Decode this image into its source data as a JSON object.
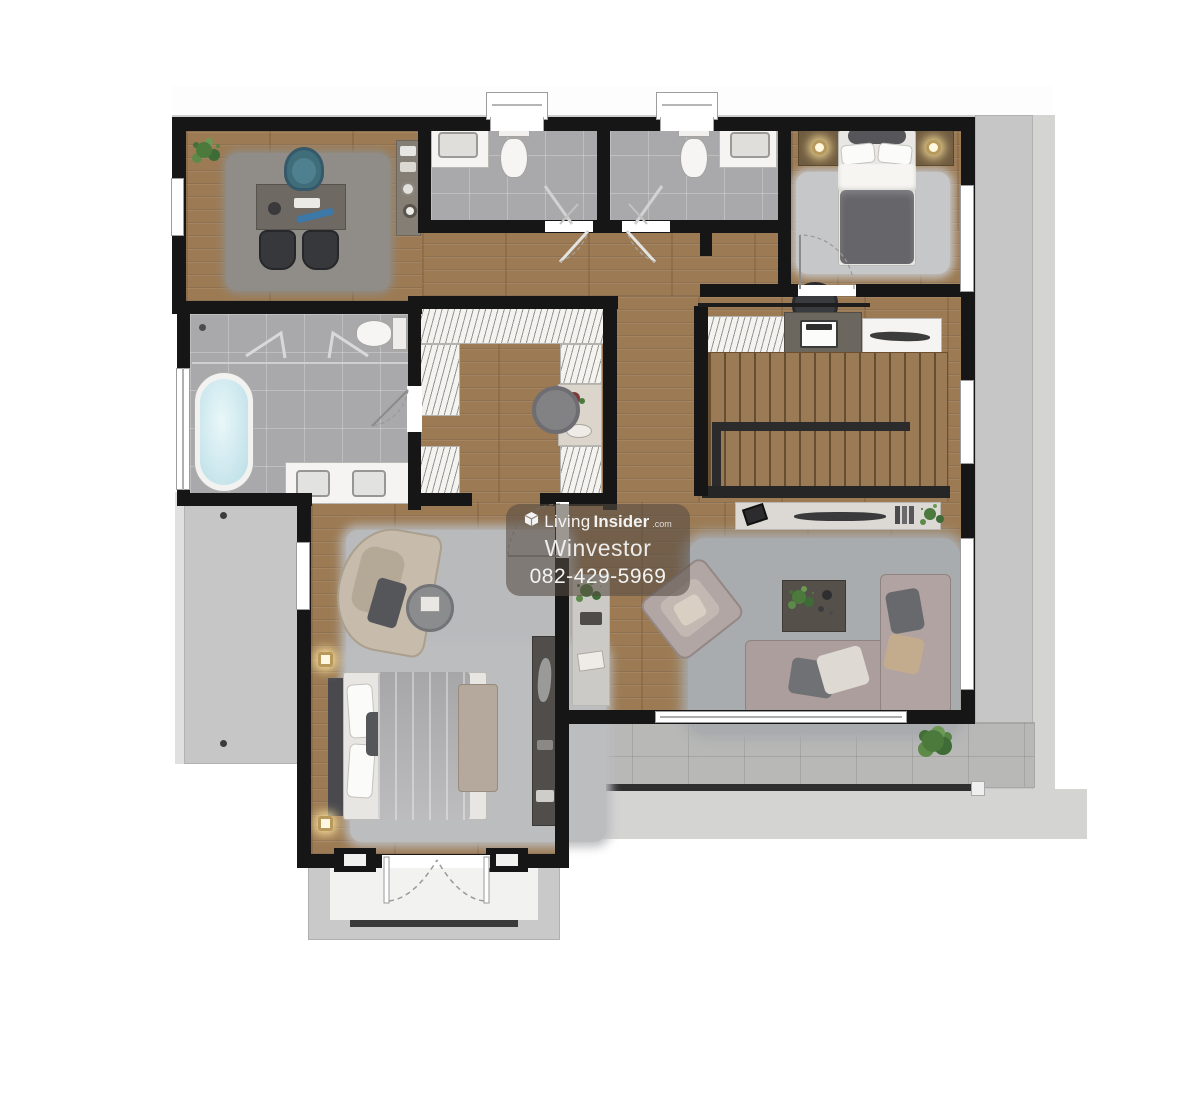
{
  "watermark": {
    "brand_light": "Living",
    "brand_bold": "Insider",
    "brand_suffix": ".com",
    "agent_name": "Winvestor",
    "phone": "082-429-5969"
  },
  "palette": {
    "wood_floor": "#9c7b54",
    "bathroom_tile": "#a9a9ab",
    "balcony_concrete": "#c6c6c6",
    "terrace_tile": "#b8b8b7",
    "wall": "#161616",
    "rug_gray": "#b9babc",
    "sofa_mauve": "#ab9e9c",
    "office_chair_teal": "#4e7e88",
    "bathtub_water": "#cfe9ef",
    "plant_green": "#4c7a3d",
    "stair_rail": "#2b2b2b",
    "watermark_bg": "rgba(86,76,68,0.58)",
    "watermark_text": "#f3f3f3"
  }
}
